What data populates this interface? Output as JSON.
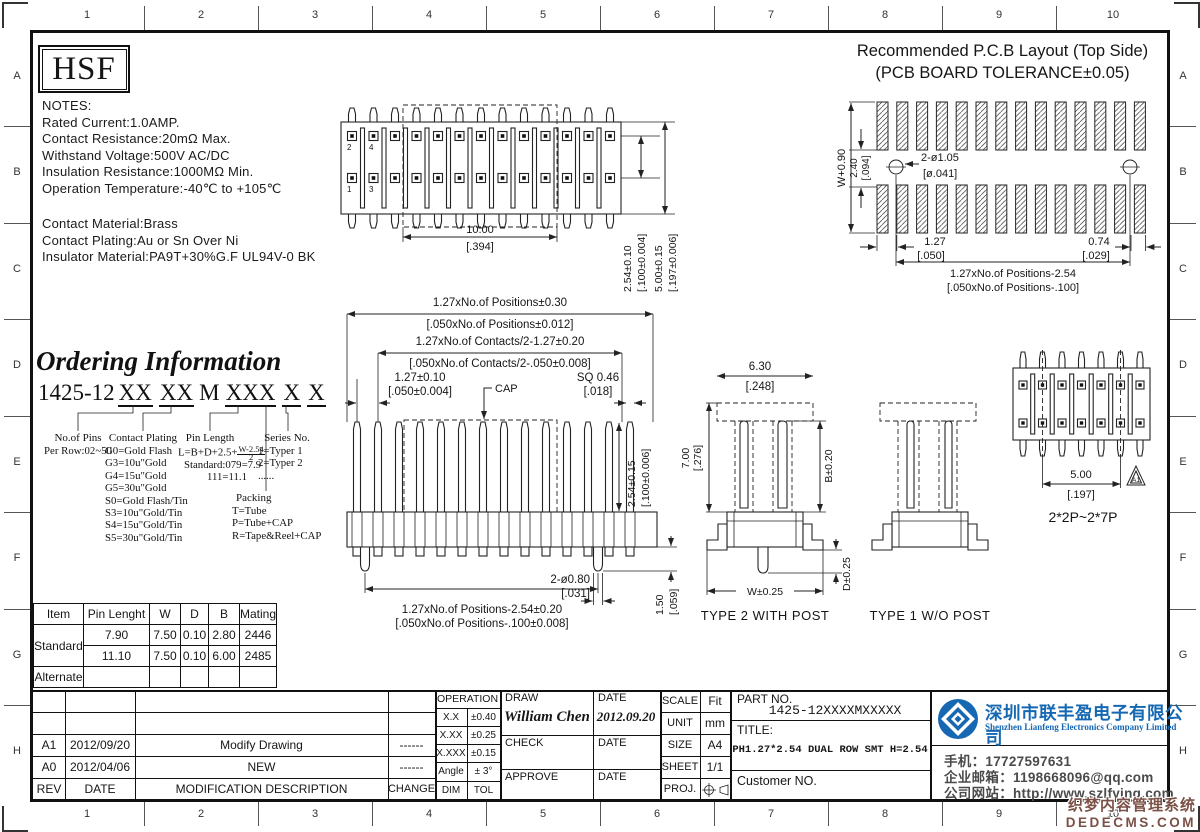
{
  "frame": {
    "cols": [
      "1",
      "2",
      "3",
      "4",
      "5",
      "6",
      "7",
      "8",
      "9",
      "10"
    ],
    "rows": [
      "A",
      "B",
      "C",
      "D",
      "E",
      "F",
      "G",
      "H"
    ]
  },
  "logo_text": "HSF",
  "notes": {
    "l1": "NOTES:",
    "l2": "Rated Current:1.0AMP.",
    "l3": "Contact Resistance:20mΩ Max.",
    "l4": "Withstand Voltage:500V AC/DC",
    "l5": "Insulation Resistance:1000MΩ Min.",
    "l6": "Operation Temperature:-40℃ to +105℃",
    "l7": "Contact Material:Brass",
    "l8": "Contact Plating:Au or Sn Over Ni",
    "l9": "Insulator Material:PA9T+30%G.F UL94V-0 BK"
  },
  "pcb": {
    "title1": "Recommended P.C.B Layout (Top Side)",
    "title2": "(PCB BOARD TOLERANCE±0.05)",
    "dim_w": "W+0.90",
    "dim_240": "2.40",
    "dim_240b": "[.094]",
    "holes": "2-ø1.05",
    "holesb": "[ø.041]",
    "pitch": "1.27",
    "pitchb": "[.050]",
    "edge": "0.74",
    "edgeb": "[.029]",
    "span": "1.27xNo.of Positions-2.54",
    "spanb": "[.050xNo.of Positions-.100]"
  },
  "top_view": {
    "pin2": "2",
    "pin4": "4",
    "pin1": "1",
    "pin3": "3",
    "dim_10": "10.00",
    "dim_10b": "[.394]",
    "dim_254": "2.54±0.10",
    "dim_254b": "[.100±0.004]",
    "dim_500": "5.00±0.15",
    "dim_500b": "[.197±0.006]"
  },
  "front_view": {
    "l1": "1.27xNo.of Positions±0.30",
    "l1b": "[.050xNo.of Positions±0.012]",
    "l2": "1.27xNo.of Contacts/2-1.27±0.20",
    "l2b": "[.050xNo.of Contacts/2-.050±0.008]",
    "l3": "1.27±0.10",
    "l3b": "[.050±0.004]",
    "cap": "CAP",
    "sq": "SQ 0.46",
    "sqb": "[.018]",
    "r1": "2.54±0.15",
    "r1b": "[.100±0.006]",
    "hole": "2-ø0.80",
    "holeb": "[.031]",
    "h15": "1.50",
    "h15b": "[.059]",
    "b1": "1.27xNo.of Positions-2.54±0.20",
    "b1b": "[.050xNo.of Positions-.100±0.008]"
  },
  "ordering": {
    "title": "Ordering Information",
    "prefix": "1425-12",
    "g1": "XX",
    "g2": "XX",
    "g3": "M",
    "g4": "XXX",
    "g5": "X",
    "g6": "X",
    "pins_t": "No.of Pins",
    "pins_v": "Per Row:02~50",
    "plating_t": "Contact Plating",
    "plating": [
      "G0=Gold Flash",
      "G3=10u\"Gold",
      "G4=15u\"Gold",
      "G5=30u\"Gold",
      "S0=Gold Flash/Tin",
      "S3=10u\"Gold/Tin",
      "S4=15u\"Gold/Tin",
      "S5=30u\"Gold/Tin"
    ],
    "pinlen_t": "Pin Length",
    "formula_pre": "L=B+D+2.5+",
    "formula_num": "W-2.54",
    "formula_den": "2",
    "pinlen_std": "Standard:079=7.9",
    "pinlen_111": "111=11.1",
    "series_t": "Series No.",
    "series": [
      "1=Typer 1",
      "2=Typer 2",
      "......"
    ],
    "packing_t": "Packing",
    "packing": [
      "T=Tube",
      "P=Tube+CAP",
      "R=Tape&Reel+CAP"
    ]
  },
  "type2": {
    "d630": "6.30",
    "d630b": "[.248]",
    "d700": "7.00",
    "d700b": "[.276]",
    "b": "B±0.20",
    "w": "W±0.25",
    "d": "D±0.25",
    "label": "TYPE 2 WITH POST"
  },
  "type1": {
    "label": "TYPE 1 W/O POST"
  },
  "small_view": {
    "d500": "5.00",
    "d500b": "[.197]",
    "range": "2*2P~2*7P",
    "tri": "A1"
  },
  "spec_table": {
    "h": [
      "Item",
      "Pin Lenght",
      "W",
      "D",
      "B",
      "Mating"
    ],
    "standard": "Standard",
    "alternate": "Alternate",
    "r1": [
      "7.90",
      "7.50",
      "0.10",
      "2.80",
      "2446"
    ],
    "r2": [
      "11.10",
      "7.50",
      "0.10",
      "6.00",
      "2485"
    ]
  },
  "revisions": {
    "h_rev": "REV",
    "h_date": "DATE",
    "h_desc": "MODIFICATION DESCRIPTION",
    "h_chg": "CHANGE",
    "rows": [
      {
        "rev": "A1",
        "date": "2012/09/20",
        "desc": "Modify Drawing",
        "chg": "------"
      },
      {
        "rev": "A0",
        "date": "2012/04/06",
        "desc": "NEW",
        "chg": "------"
      }
    ]
  },
  "titleblock": {
    "operation": "OPERATION",
    "tol": [
      [
        "X.X",
        "±0.40"
      ],
      [
        "X.XX",
        "±0.25"
      ],
      [
        "X.XXX",
        "±0.15"
      ],
      [
        "Angle",
        "± 3°"
      ],
      [
        "DIM",
        "TOL"
      ]
    ],
    "draw": "DRAW",
    "draw_name": "William Chen",
    "draw_date": "2012.09.20",
    "check": "CHECK",
    "approve": "APPROVE",
    "date": "DATE",
    "scale": "SCALE",
    "scale_v": "Fit",
    "unit": "UNIT",
    "unit_v": "mm",
    "size": "SIZE",
    "size_v": "A4",
    "sheet": "SHEET",
    "sheet_v": "1/1",
    "proj": "PROJ.",
    "part_label": "PART NO.",
    "part_no": "1425-12XXXXMXXXXX",
    "title_label": "TITLE:",
    "title": "PH1.27*2.54 DUAL ROW SMT H=2.54",
    "customer_label": "Customer NO."
  },
  "company": {
    "name_cn": "深圳市联丰盈电子有限公司",
    "name_en": "Shenzhen Lianfeng Electronics Company Limited",
    "phone": "手机：17727597631",
    "email": "企业邮箱：1198668096@qq.com",
    "site": "公司网站：http://www.szlfying.com",
    "brand_color": "#1668b3"
  },
  "watermark": {
    "line1": "织梦内容管理系统",
    "line2": "DEDECMS.COM"
  }
}
